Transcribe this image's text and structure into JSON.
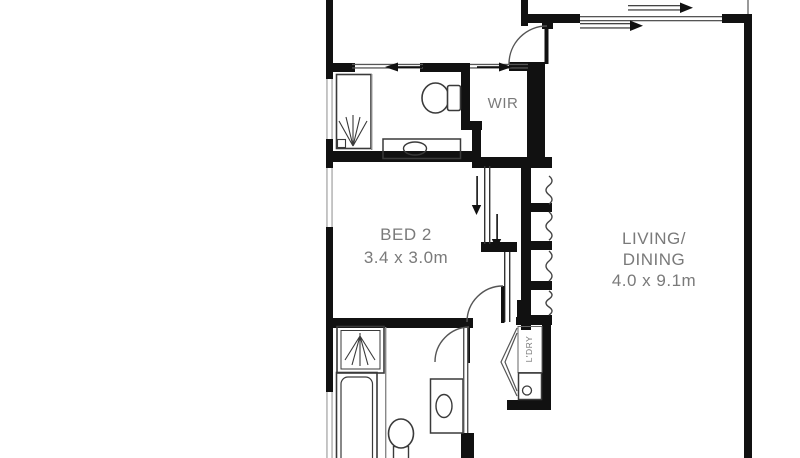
{
  "rooms": {
    "bed2": {
      "name": "BED 2",
      "dims": "3.4 x 3.0m"
    },
    "living": {
      "name_line1": "LIVING/",
      "name_line2": "DINING",
      "dims": "4.0 x 9.1m"
    },
    "wir": {
      "name": "WIR"
    },
    "laundry": {
      "name": "L'DRY"
    }
  },
  "colors": {
    "wall": "#111111",
    "fixture_line": "#3a3a3a",
    "thin_partition": "#888888",
    "window_line": "#b3b3b3",
    "label_text": "#7a7a7a",
    "background": "#ffffff"
  }
}
